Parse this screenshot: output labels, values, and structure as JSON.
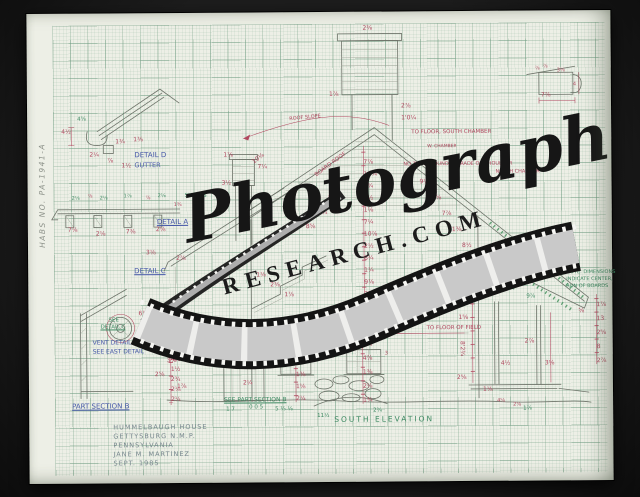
{
  "photo": {
    "margin_label": "HABS NO. PA-1941-A"
  },
  "watermark": {
    "script": "Photograph",
    "caps": "RESEARCH.COM"
  },
  "title_block": {
    "lines": [
      "HUMMELBAUGH HOUSE",
      "GETTYSBURG N.M.P.",
      "PENNSYLVANIA",
      "JANE M. MARTINEZ",
      "SEPT. 1985"
    ]
  },
  "colors": {
    "red": "#b0485f",
    "green": "#3f8a63",
    "blue": "#4658a8",
    "pencil": "#6d736b"
  },
  "annotations": [
    {
      "t": "DETAIL D",
      "x": 107,
      "y": 139,
      "c": "blue",
      "s": 7,
      "n": "label-detail-d"
    },
    {
      "t": "GUTTER",
      "x": 107,
      "y": 149,
      "c": "blue",
      "s": 6.5,
      "n": "label-gutter"
    },
    {
      "t": "DETAIL A",
      "x": 129,
      "y": 206,
      "c": "blue",
      "s": 7,
      "u": 1,
      "n": "label-detail-a"
    },
    {
      "t": "DETAIL C",
      "x": 106,
      "y": 255,
      "c": "blue",
      "s": 7,
      "u": 1,
      "n": "label-detail-c"
    },
    {
      "t": "VENT DETAIL",
      "x": 64,
      "y": 327,
      "c": "blue",
      "s": 6,
      "n": "label-vent-detail"
    },
    {
      "t": "SEE EAST DETAIL",
      "x": 64,
      "y": 336,
      "c": "blue",
      "s": 6,
      "n": "label-see-east-detail"
    },
    {
      "t": "PART SECTION B",
      "x": 43,
      "y": 390,
      "c": "blue",
      "s": 7,
      "u": 1,
      "n": "label-part-section-b"
    },
    {
      "t": "SEE",
      "x": 80,
      "y": 305,
      "c": "green",
      "s": 5.5
    },
    {
      "t": "DETAIL C",
      "x": 72,
      "y": 312,
      "c": "green",
      "s": 5.5,
      "u": 1
    },
    {
      "t": "SHAKES",
      "x": 157,
      "y": 181,
      "c": "green",
      "s": 5.5,
      "n": "label-shakes"
    },
    {
      "t": "SEE PART SECTION B",
      "x": 195,
      "y": 385,
      "c": "green",
      "s": 6,
      "u": 1,
      "n": "label-see-part-section-b"
    },
    {
      "t": "SOUTH ELEVATION",
      "x": 305,
      "y": 404,
      "c": "green",
      "s": 7.5,
      "ls": 2,
      "n": "label-south-elevation"
    },
    {
      "t": "NOTE: DIMENSIONS",
      "x": 538,
      "y": 260,
      "c": "green",
      "s": 5
    },
    {
      "t": "INDICATE CENTER,",
      "x": 538,
      "y": 267,
      "c": "green",
      "s": 5
    },
    {
      "t": "RUN OF BOARDS",
      "x": 538,
      "y": 274,
      "c": "green",
      "s": 5
    },
    {
      "t": "10¾",
      "x": 474,
      "y": 276,
      "c": "green",
      "s": 5.5
    },
    {
      "t": "9⅞",
      "x": 498,
      "y": 284,
      "c": "green",
      "s": 5.5
    },
    {
      "t": "1 7",
      "x": 197,
      "y": 395,
      "c": "green",
      "s": 5.5
    },
    {
      "t": "0 0 5",
      "x": 220,
      "y": 393,
      "c": "green",
      "s": 5.5
    },
    {
      "t": "5 ⅓ ⅛",
      "x": 246,
      "y": 395,
      "c": "green",
      "s": 5.5
    },
    {
      "t": "11½",
      "x": 288,
      "y": 402,
      "c": "green",
      "s": 5.5
    },
    {
      "t": "2¾",
      "x": 344,
      "y": 397,
      "c": "green",
      "s": 5.5
    },
    {
      "t": "4⅝",
      "x": 50,
      "y": 104,
      "c": "green",
      "s": 5.5
    },
    {
      "t": "1⅞",
      "x": 494,
      "y": 396,
      "c": "green",
      "s": 5.5
    },
    {
      "t": "TO FLOOR, SOUTH CHAMBER",
      "x": 384,
      "y": 119,
      "c": "red",
      "s": 5.5,
      "n": "note-to-floor-south-chamber"
    },
    {
      "t": "W. CHAMBER",
      "x": 400,
      "y": 134,
      "c": "red",
      "s": 4.5
    },
    {
      "t": "NO TRIM AROUND IT GRADE OR SHOULDER",
      "x": 376,
      "y": 151,
      "c": "red",
      "s": 5,
      "n": "note-no-trim"
    },
    {
      "t": "NORTH CHAMBER",
      "x": 468,
      "y": 159,
      "c": "red",
      "s": 5
    },
    {
      "t": "ALL THIS TRIM IS SIMILAR",
      "x": 455,
      "y": 249,
      "c": "red",
      "s": 5,
      "r": -10,
      "n": "note-trim-similar"
    },
    {
      "t": "TO FLOOR OF FIELD",
      "x": 398,
      "y": 315,
      "c": "red",
      "s": 5.5,
      "n": "note-to-floor-of-field"
    },
    {
      "t": "BOARD ROOF",
      "x": 287,
      "y": 162,
      "c": "red",
      "s": 5.5,
      "r": -36,
      "n": "note-board-roof"
    },
    {
      "t": "ROOF SLOPE",
      "x": 262,
      "y": 105,
      "c": "red",
      "s": 5,
      "r": -5
    },
    {
      "t": "7⅞",
      "x": 514,
      "y": 82,
      "c": "red",
      "s": 6
    },
    {
      "t": "7⅞",
      "x": 336,
      "y": 148
    },
    {
      "t": "11¼",
      "x": 336,
      "y": 160
    },
    {
      "t": "2¾",
      "x": 336,
      "y": 172
    },
    {
      "t": "9½",
      "x": 336,
      "y": 184
    },
    {
      "t": "1⅛",
      "x": 336,
      "y": 196
    },
    {
      "t": "7¼",
      "x": 336,
      "y": 208
    },
    {
      "t": "10⅞",
      "x": 336,
      "y": 220
    },
    {
      "t": "2½",
      "x": 336,
      "y": 232
    },
    {
      "t": "8¾",
      "x": 336,
      "y": 244
    },
    {
      "t": "1¼",
      "x": 336,
      "y": 256
    },
    {
      "t": "9⅞",
      "x": 336,
      "y": 268
    },
    {
      "t": "3⅛",
      "x": 336,
      "y": 280
    },
    {
      "t": "7½",
      "x": 336,
      "y": 292
    },
    {
      "t": "2⅜",
      "x": 336,
      "y": 14
    },
    {
      "t": "1⅞",
      "x": 302,
      "y": 80
    },
    {
      "t": "2⅞",
      "x": 374,
      "y": 92
    },
    {
      "t": "1'0¼",
      "x": 374,
      "y": 104
    },
    {
      "t": "1⅞",
      "x": 196,
      "y": 140
    },
    {
      "t": "7¼",
      "x": 230,
      "y": 152
    },
    {
      "t": "3½",
      "x": 194,
      "y": 168
    },
    {
      "t": "2¾",
      "x": 232,
      "y": 182
    },
    {
      "t": "4½",
      "x": 34,
      "y": 116
    },
    {
      "t": "1¾",
      "x": 88,
      "y": 126
    },
    {
      "t": "1⅜",
      "x": 106,
      "y": 124
    },
    {
      "t": "2¼",
      "x": 62,
      "y": 139
    },
    {
      "t": "⅞",
      "x": 80,
      "y": 145
    },
    {
      "t": "1½",
      "x": 94,
      "y": 150
    },
    {
      "t": "2⅛",
      "x": 44,
      "y": 183,
      "c": "green",
      "s": 5
    },
    {
      "t": "⅞",
      "x": 60,
      "y": 181,
      "s": 5
    },
    {
      "t": "2⅛",
      "x": 72,
      "y": 183,
      "c": "green",
      "s": 5
    },
    {
      "t": "1⅞",
      "x": 96,
      "y": 181,
      "c": "green",
      "s": 5
    },
    {
      "t": "⅞",
      "x": 118,
      "y": 183,
      "s": 5
    },
    {
      "t": "2⅛",
      "x": 130,
      "y": 181,
      "c": "green",
      "s": 5
    },
    {
      "t": "1¾",
      "x": 146,
      "y": 190,
      "s": 5
    },
    {
      "t": "7⅛",
      "x": 40,
      "y": 214
    },
    {
      "t": "2⅛",
      "x": 68,
      "y": 218
    },
    {
      "t": "7⅜",
      "x": 98,
      "y": 216
    },
    {
      "t": "2⅛",
      "x": 128,
      "y": 214
    },
    {
      "t": "3⅛",
      "x": 118,
      "y": 237
    },
    {
      "t": "2⅞",
      "x": 148,
      "y": 243
    },
    {
      "t": "1⅛",
      "x": 228,
      "y": 260
    },
    {
      "t": "2⅜",
      "x": 242,
      "y": 270
    },
    {
      "t": "1⅞",
      "x": 256,
      "y": 280
    },
    {
      "t": "6⅞",
      "x": 110,
      "y": 298
    },
    {
      "t": "2¼",
      "x": 116,
      "y": 316
    },
    {
      "t": "5½",
      "x": 128,
      "y": 330
    },
    {
      "t": "3⅛",
      "x": 138,
      "y": 345
    },
    {
      "t": "2⅝",
      "x": 126,
      "y": 359
    },
    {
      "t": "1⅞",
      "x": 148,
      "y": 371
    },
    {
      "t": "2⅝",
      "x": 142,
      "y": 324
    },
    {
      "t": "1⅛",
      "x": 142,
      "y": 334
    },
    {
      "t": "4½",
      "x": 142,
      "y": 344
    },
    {
      "t": "1½",
      "x": 142,
      "y": 354
    },
    {
      "t": "2¾",
      "x": 142,
      "y": 364
    },
    {
      "t": "2⅛",
      "x": 142,
      "y": 374
    },
    {
      "t": "2¼",
      "x": 142,
      "y": 384
    },
    {
      "t": "2⅝",
      "x": 214,
      "y": 332
    },
    {
      "t": "2⅛",
      "x": 214,
      "y": 350
    },
    {
      "t": "2¼",
      "x": 214,
      "y": 368
    },
    {
      "t": "1⅜",
      "x": 267,
      "y": 360
    },
    {
      "t": "1⅛",
      "x": 267,
      "y": 372
    },
    {
      "t": "2¼",
      "x": 267,
      "y": 384
    },
    {
      "t": "1⅝",
      "x": 334,
      "y": 330
    },
    {
      "t": "4⅞",
      "x": 334,
      "y": 344
    },
    {
      "t": "1⅜",
      "x": 334,
      "y": 358
    },
    {
      "t": "2⅛",
      "x": 334,
      "y": 372
    },
    {
      "t": "1¾",
      "x": 334,
      "y": 386
    },
    {
      "t": "1⅞",
      "x": 568,
      "y": 292
    },
    {
      "t": "13",
      "x": 568,
      "y": 306
    },
    {
      "t": "2⅝",
      "x": 568,
      "y": 320
    },
    {
      "t": "8",
      "x": 568,
      "y": 334
    },
    {
      "t": "2⅞",
      "x": 568,
      "y": 348
    },
    {
      "t": "⅝",
      "x": 550,
      "y": 298
    },
    {
      "t": "2⅛",
      "x": 424,
      "y": 290
    },
    {
      "t": "1⅝",
      "x": 430,
      "y": 304
    },
    {
      "t": "8'2¾",
      "x": 436,
      "y": 330,
      "r": 90
    },
    {
      "t": "4½",
      "x": 472,
      "y": 350
    },
    {
      "t": "2⅞",
      "x": 496,
      "y": 328
    },
    {
      "t": "3⅛",
      "x": 516,
      "y": 350
    },
    {
      "t": "2⅝",
      "x": 428,
      "y": 364
    },
    {
      "t": "1⅛",
      "x": 454,
      "y": 376
    },
    {
      "t": "4⅝",
      "x": 468,
      "y": 388,
      "s": 5
    },
    {
      "t": "2⅞",
      "x": 484,
      "y": 392,
      "s": 5
    },
    {
      "t": "⅞",
      "x": 508,
      "y": 56,
      "s": 5
    },
    {
      "t": "⅞",
      "x": 516,
      "y": 54,
      "s": 5
    },
    {
      "t": "3⅛",
      "x": 530,
      "y": 58,
      "s": 5
    },
    {
      "t": "4",
      "x": 546,
      "y": 72,
      "s": 5
    },
    {
      "t": "10⅛",
      "x": 224,
      "y": 148,
      "r": -36
    },
    {
      "t": "9¼",
      "x": 392,
      "y": 168
    },
    {
      "t": "2⅝",
      "x": 404,
      "y": 184
    },
    {
      "t": "7⅞",
      "x": 414,
      "y": 200
    },
    {
      "t": "1⅜",
      "x": 424,
      "y": 216
    },
    {
      "t": "8½",
      "x": 434,
      "y": 232
    },
    {
      "t": "2⅞",
      "x": 300,
      "y": 184
    },
    {
      "t": "1¾",
      "x": 290,
      "y": 198
    },
    {
      "t": "8⅝",
      "x": 278,
      "y": 212
    },
    {
      "t": "1⅛",
      "x": 250,
      "y": 330,
      "s": 5
    },
    {
      "t": "2⅜",
      "x": 316,
      "y": 332,
      "s": 5
    },
    {
      "t": "3",
      "x": 356,
      "y": 340,
      "s": 5
    }
  ]
}
